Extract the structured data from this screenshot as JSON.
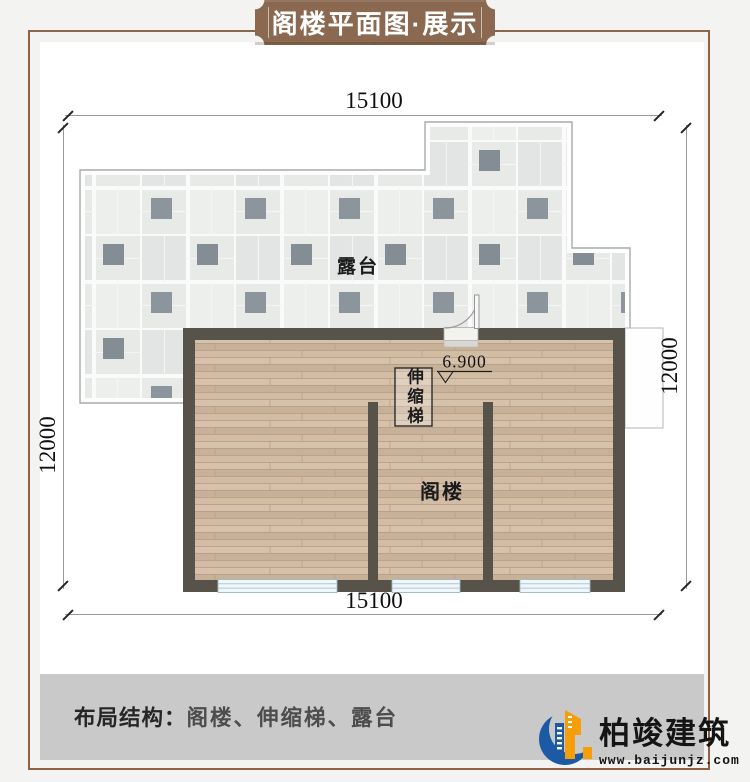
{
  "banner": {
    "title": "阁楼平面图·展示"
  },
  "dims": {
    "top": "15100",
    "bottom": "15100",
    "left": "12000",
    "right": "12000"
  },
  "plan": {
    "terrace_label": "露台",
    "attic_label": "阁楼",
    "ladder_label": "伸缩梯",
    "level_value": "6.900"
  },
  "footer": {
    "structure_label": "布局结构：",
    "structure_value": "阁楼、伸缩梯、露台"
  },
  "logo": {
    "name": "柏竣建筑",
    "url": "www.baijunjz.com"
  },
  "colors": {
    "banner_brown": "#8a6950",
    "frame_brown": "#8f6143",
    "wall_dark": "#57534a",
    "wood_base": "#cdb69e",
    "tile_light": "#e8eae8",
    "tile_dark": "#868f96",
    "window_blue": "#eef6fa",
    "footer_gray": "#c9c9c9",
    "logo_blue": "#1d5aa5",
    "logo_orange": "#f59e0b"
  }
}
